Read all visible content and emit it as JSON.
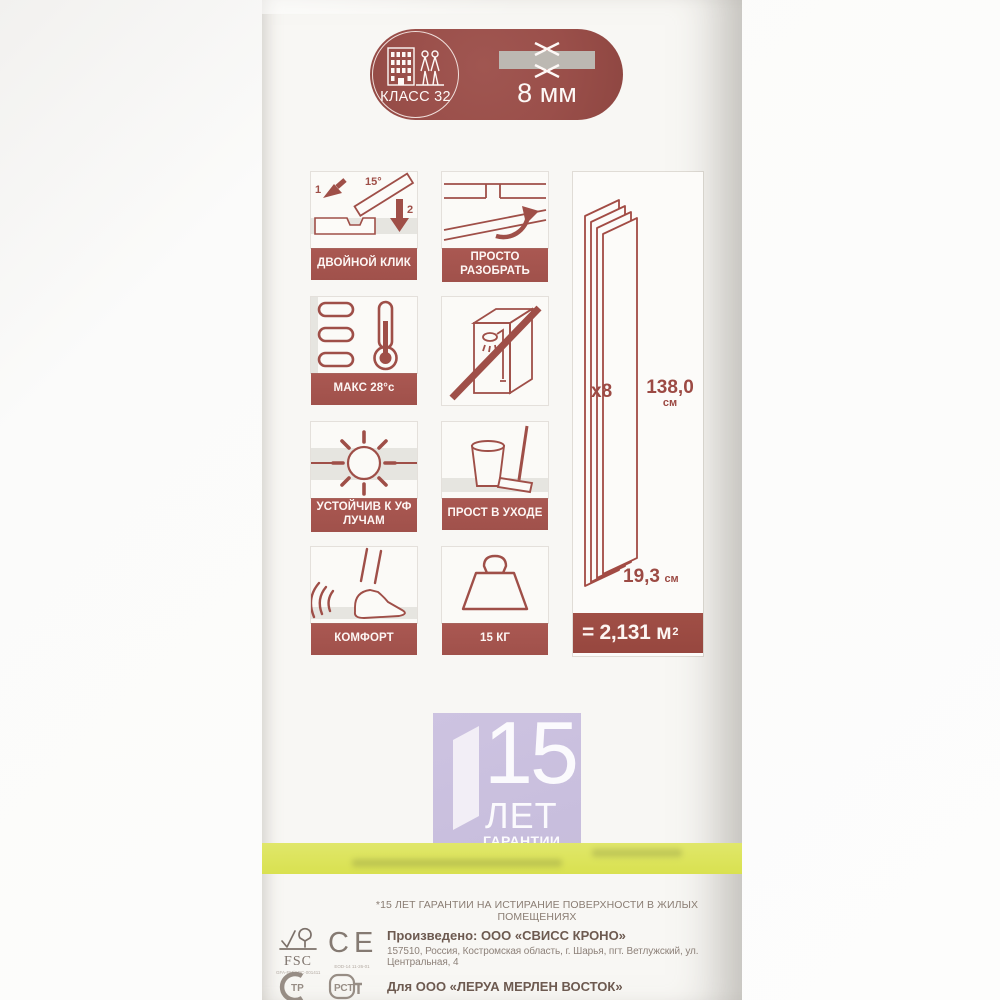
{
  "colors": {
    "maroon": "#9a4f4a",
    "label_band": "#a0514b",
    "yellow": "#dde45d",
    "purple": "#c9bfde",
    "beige": "#e3dac7"
  },
  "pill": {
    "class_label": "КЛАСС 32",
    "thickness": "8 мм"
  },
  "features": [
    {
      "icon": "double-click-icon",
      "label": "ДВОЙНОЙ КЛИК",
      "annotations": {
        "step1": "1",
        "angle": "15°",
        "step2": "2"
      }
    },
    {
      "icon": "easy-disassemble-icon",
      "label": "ПРОСТО РАЗОБРАТЬ"
    },
    {
      "icon": "underfloor-heating-icon",
      "label": "МАКС 28°c"
    },
    {
      "icon": "no-wet-rooms-icon",
      "label": ""
    },
    {
      "icon": "uv-resistant-icon",
      "label": "УСТОЙЧИВ К УФ ЛУЧАМ"
    },
    {
      "icon": "easy-care-icon",
      "label": "ПРОСТ В УХОДЕ"
    },
    {
      "icon": "comfort-icon",
      "label": "КОМФОРТ"
    },
    {
      "icon": "max-load-icon",
      "label": "15 КГ"
    }
  ],
  "pack_panel": {
    "count": "x8",
    "length_value": "138,0",
    "length_unit": "см",
    "width_value": "19,3",
    "width_unit": "см",
    "area_value": "= 2,131 м",
    "area_sup": "2"
  },
  "warranty": {
    "years": "15",
    "unit": "ЛЕТ",
    "caption": "ГАРАНТИИ"
  },
  "footnote": "*15 ЛЕТ ГАРАНТИИ НА ИСТИРАНИЕ ПОВЕРХНОСТИ В ЖИЛЫХ ПОМЕЩЕНИЯХ",
  "manufacturer": {
    "title": "Произведено: ООО «СВИСС КРОНО»",
    "address": "157510, Россия, Костромская область, г. Шарья, пгт. Ветлужский, ул. Центральная, 4",
    "distributor": "Для ООО «ЛЕРУА МЕРЛЕН ВОСТОК»"
  },
  "certs": {
    "fsc_label": "FSC",
    "fsc_code": "GFA-FM/COC-001411",
    "ce_label": "CE",
    "ce_code": "EOD-14 11-26-01",
    "fire_mark": "ТР",
    "rst_mark": "РСТ"
  }
}
